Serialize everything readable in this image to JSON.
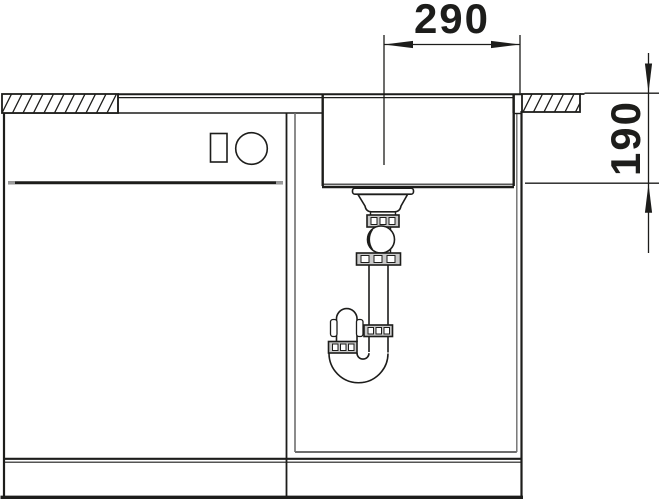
{
  "diagram": {
    "dimensions": {
      "horizontal": {
        "label": "290"
      },
      "vertical": {
        "label": "190"
      }
    },
    "colors": {
      "line": "#1d1d1b",
      "inner_panel_gray": "#6e6e6e",
      "nut_gray": "#c9c9c9",
      "gap_tip_gray": "#9a9a9a",
      "background": "#ffffff"
    },
    "parts": {
      "worktop_left": "worktop-hatched-section-left",
      "worktop_right": "worktop-hatched-section-right",
      "sink_rim": "sink-rim-surface",
      "basin": "sink-basin",
      "drain_centerline": "drain-centerline",
      "strainer": "drain-strainer-assembly",
      "ball_joint": "ball-joint",
      "trap": "siphon-trap",
      "cabinet": "base-cabinet",
      "divider": "cabinet-divider",
      "drawer_gap": "drawer-gap-line",
      "handle_rect": "front-symbol-rectangle",
      "handle_circle": "front-symbol-circle",
      "plinth": "plinth"
    }
  }
}
